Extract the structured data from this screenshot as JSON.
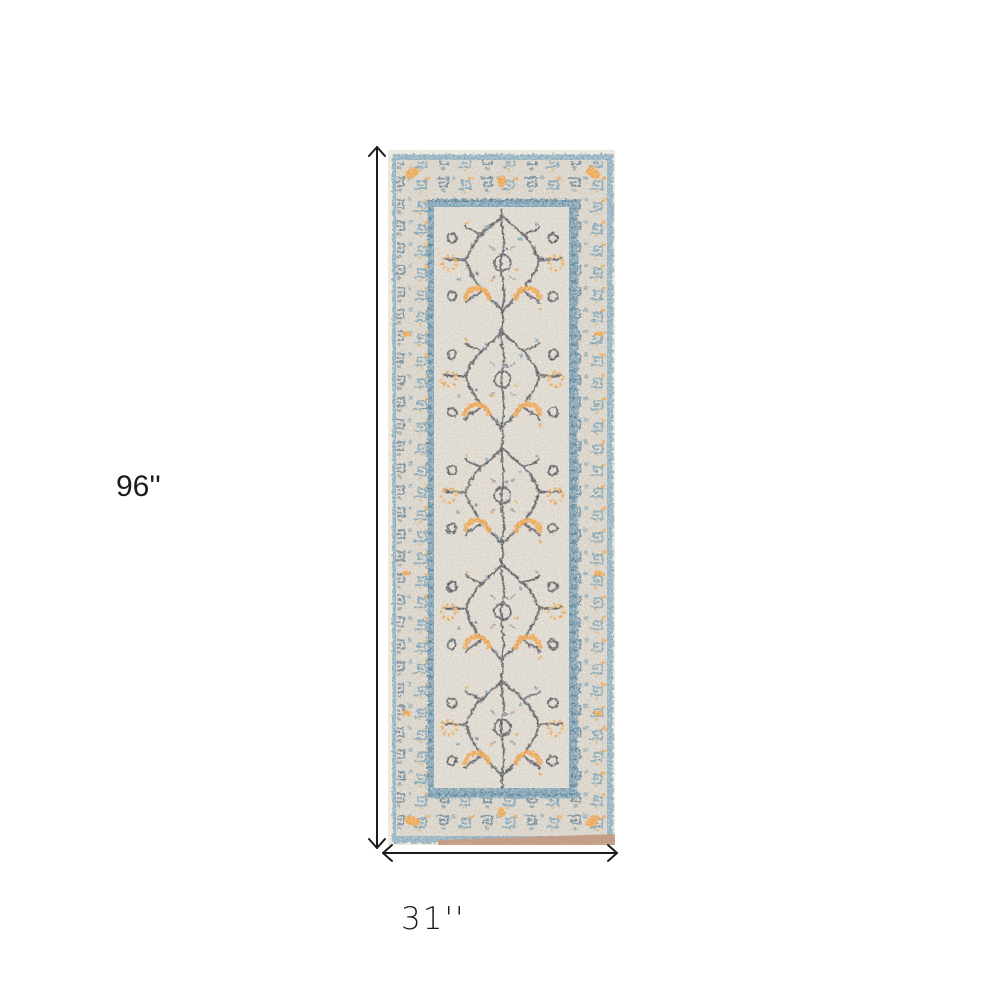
{
  "figure": {
    "height_label": "96''",
    "width_label": "31''"
  },
  "theme": {
    "bg": "#ffffff",
    "ink": "#1c1c1e",
    "rug-edge": "#ece6da",
    "rug-stripe": "#7ba3b8",
    "rug-band": "#d5cfc4",
    "rug-blue": "#6692aa",
    "rug-blue-dark": "#38617d",
    "rug-guard": "#6e96ad",
    "rug-field": "#dbd5cb",
    "rug-orange": "#ee9c3c",
    "rug-charcoal": "#474850",
    "rug-purple": "#7c6184",
    "rug-gold": "#d8a34a",
    "rug-tan": "#c79a82"
  }
}
